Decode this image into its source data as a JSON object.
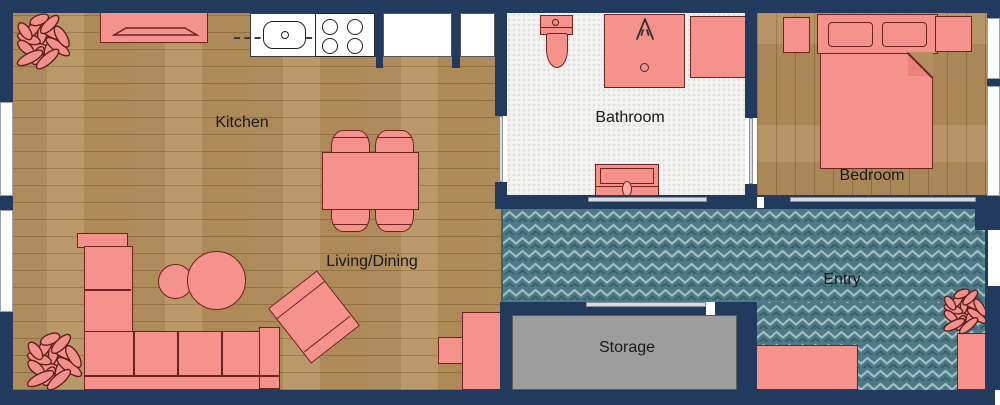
{
  "rooms": [
    {
      "name": "kitchen",
      "label": "Kitchen"
    },
    {
      "name": "living_dining",
      "label": "Living/Dining"
    },
    {
      "name": "bathroom",
      "label": "Bathroom"
    },
    {
      "name": "bedroom",
      "label": "Bedroom"
    },
    {
      "name": "entry",
      "label": "Entry"
    },
    {
      "name": "storage",
      "label": "Storage"
    }
  ],
  "colors": {
    "wall": "#223a5e",
    "furniture_fill": "#f5928b",
    "furniture_outline": "#6b2420",
    "wood_floor": "#b7925f",
    "bathroom_tile": "#f2f2f0",
    "entry_herringbone": "#4e7a87",
    "storage_floor": "#9d9d9d",
    "window": "#ffffff",
    "sliding_door": "#d8dbdf",
    "label_text": "#191919"
  },
  "icons": [
    {
      "name": "plant-icon"
    },
    {
      "name": "shower-head-icon"
    },
    {
      "name": "stove-burners-icon"
    },
    {
      "name": "sink-basin-icon"
    }
  ]
}
